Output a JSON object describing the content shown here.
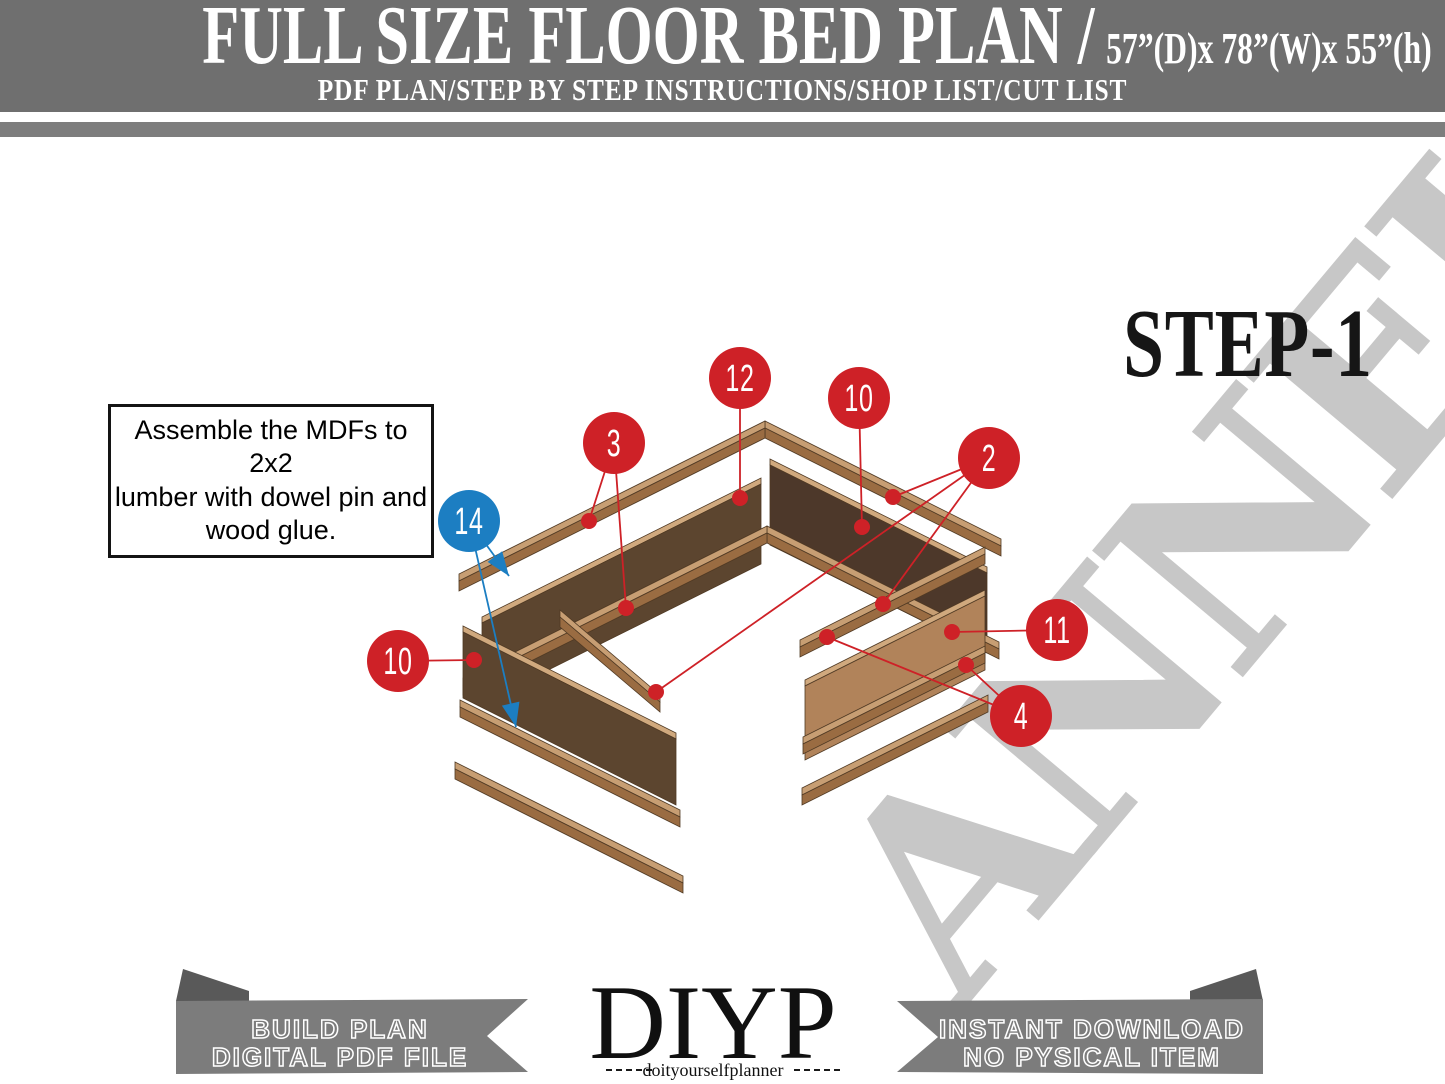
{
  "header": {
    "title": "FULL SIZE FLOOR BED PLAN /",
    "dimensions": "57”(D)x 78”(W)x 55”(h)",
    "subtitle": "PDF PLAN/STEP BY STEP INSTRUCTIONS/SHOP LIST/CUT LIST",
    "bg_color": "#6f6f6f"
  },
  "step_label": "STEP-1",
  "instruction_box": {
    "lines": [
      "Assemble the MDFs to 2x2",
      "lumber with dowel pin and",
      "wood glue."
    ]
  },
  "watermark": {
    "text": "ANNEL",
    "color": "#c7c7c7"
  },
  "colors": {
    "red": "#ce2127",
    "blue": "#1c7ec2",
    "rail_top": "#c79e73",
    "rail_front": "#9a6c42",
    "panel_edge": "#d0a97e",
    "panel_dark": "#5c452f",
    "panel_darker": "#4d382a",
    "panel_light": "#b1835a",
    "wood_stroke": "#503a24",
    "header_gray": "#6f6f6f",
    "ribbon_gray": "#7c7c7c",
    "ribbon_fold": "#595959"
  },
  "diagram": {
    "pieces": [
      {
        "type": "rail",
        "p": [
          765,
          421
        ],
        "q": [
          1001,
          539
        ]
      },
      {
        "type": "rail",
        "p": [
          765,
          421
        ],
        "q": [
          459,
          574
        ]
      },
      {
        "type": "panel",
        "a": [
          770,
          459
        ],
        "b": [
          987,
          567
        ],
        "h": 86,
        "tone": "darker"
      },
      {
        "type": "panel",
        "a": [
          482,
          617
        ],
        "b": [
          761,
          478
        ],
        "h": 86,
        "tone": "dark"
      },
      {
        "type": "rail",
        "p": [
          767,
          526
        ],
        "q": [
          999,
          642
        ]
      },
      {
        "type": "rail",
        "p": [
          767,
          526
        ],
        "q": [
          463,
          678
        ]
      },
      {
        "type": "rail",
        "p": [
          800,
          640
        ],
        "q": [
          985,
          547
        ]
      },
      {
        "type": "panel",
        "a": [
          805,
          680
        ],
        "b": [
          985,
          590
        ],
        "h": 80,
        "tone": "light"
      },
      {
        "type": "rail",
        "p": [
          803,
          737
        ],
        "q": [
          985,
          646
        ]
      },
      {
        "type": "rail",
        "p": [
          802,
          788
        ],
        "q": [
          988,
          695
        ]
      },
      {
        "type": "rail",
        "p": [
          560,
          610
        ],
        "q": [
          660,
          695
        ]
      },
      {
        "type": "panel",
        "a": [
          463,
          626
        ],
        "b": [
          676,
          733
        ],
        "h": 72,
        "tone": "dark"
      },
      {
        "type": "rail",
        "p": [
          460,
          700
        ],
        "q": [
          680,
          810
        ]
      },
      {
        "type": "rail",
        "p": [
          455,
          762
        ],
        "q": [
          683,
          876
        ]
      }
    ],
    "callouts": [
      {
        "id": "12",
        "color": "red",
        "x": 740,
        "y": 378,
        "leaders": [
          [
            740,
            498
          ]
        ]
      },
      {
        "id": "10",
        "color": "red",
        "x": 859,
        "y": 398,
        "leaders": [
          [
            862,
            527
          ]
        ]
      },
      {
        "id": "3",
        "color": "red",
        "x": 614,
        "y": 443,
        "leaders": [
          [
            589,
            521
          ],
          [
            626,
            608
          ]
        ]
      },
      {
        "id": "2",
        "color": "red",
        "x": 989,
        "y": 458,
        "leaders": [
          [
            893,
            497
          ],
          [
            883,
            604
          ],
          [
            656,
            692
          ]
        ]
      },
      {
        "id": "14",
        "color": "blue",
        "x": 469,
        "y": 521,
        "arrow": true,
        "leaders": [
          [
            509,
            576
          ],
          [
            516,
            727
          ]
        ]
      },
      {
        "id": "10",
        "color": "red",
        "x": 398,
        "y": 661,
        "leaders": [
          [
            474,
            660
          ]
        ]
      },
      {
        "id": "11",
        "color": "red",
        "x": 1057,
        "y": 630,
        "leaders": [
          [
            952,
            632
          ]
        ]
      },
      {
        "id": "4",
        "color": "red",
        "x": 1021,
        "y": 716,
        "leaders": [
          [
            827,
            637
          ],
          [
            966,
            665
          ]
        ]
      }
    ]
  },
  "footer": {
    "left_ribbon": {
      "line1": "BUILD PLAN",
      "line2": "DIGITAL PDF FILE"
    },
    "right_ribbon": {
      "line1": "INSTANT DOWNLOAD",
      "line2": "NO PYSICAL ITEM"
    },
    "logo": {
      "name": "DIYP",
      "tagline": "doityourselfplanner"
    }
  }
}
